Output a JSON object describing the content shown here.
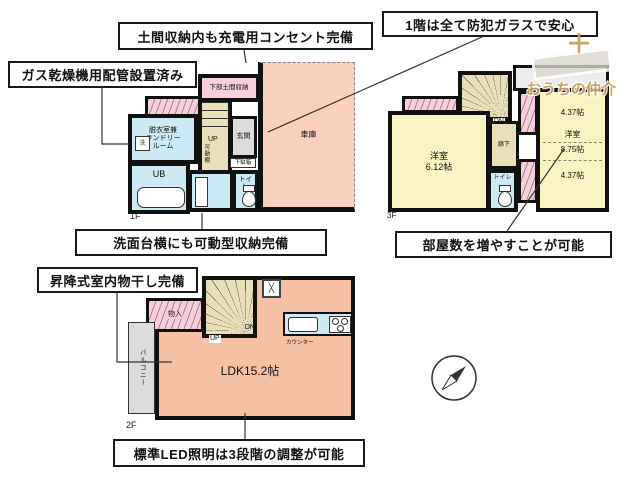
{
  "annotations": {
    "doma_outlet": "土間収納内も充電用コンセント完備",
    "security_glass": "1階は全て防犯ガラスで安心",
    "gas_dryer": "ガス乾燥機用配管設置済み",
    "washstand_storage": "洗面台横にも可動型収納完備",
    "room_increase": "部屋数を増やすことが可能",
    "indoor_drying": "昇降式室内物干し完備",
    "led_light": "標準LED照明は3段階の調整が可能"
  },
  "floor1": {
    "label": "1F",
    "doma_storage": "下部土間収納",
    "laundry_room": "脱衣室兼\nランドリー\nルーム",
    "washer": "洗",
    "garage": "車庫",
    "unit_bath": "UB",
    "entrance": "玄関",
    "shoe_box": "下駄箱",
    "toilet": "トイレ",
    "stairs_up": "UP",
    "movable_shelf": "可動棚"
  },
  "floor2": {
    "label": "2F",
    "ldk": "LDK15.2帖",
    "balcony": "バルコニー",
    "storage": "物入",
    "stairs_up": "UP",
    "stairs_dn": "DN",
    "counter": "カウンター"
  },
  "floor3": {
    "label": "3F",
    "bedroom_west": "洋室\n6.12帖",
    "hallway": "廊下",
    "toilet": "トイレ",
    "stairs_dn": "DN",
    "bedroom_east_name": "洋室",
    "bedroom_east_size": "8.75帖",
    "bedroom_east_top": "4.37帖",
    "bedroom_east_bottom": "4.37帖"
  },
  "logo": {
    "plus": "＋",
    "text": "おうちの仲介"
  },
  "colors": {
    "wall": "#111111",
    "pink": "#f9cdd9",
    "blue": "#cde9f4",
    "yellow": "#f8f3c0",
    "tan": "#e9dfb8",
    "gray": "#dcdcdc",
    "ldk_salmon": "#f6c0a4",
    "garage_peach": "#f9d0bd",
    "logo_gold": "#c9a05a"
  }
}
